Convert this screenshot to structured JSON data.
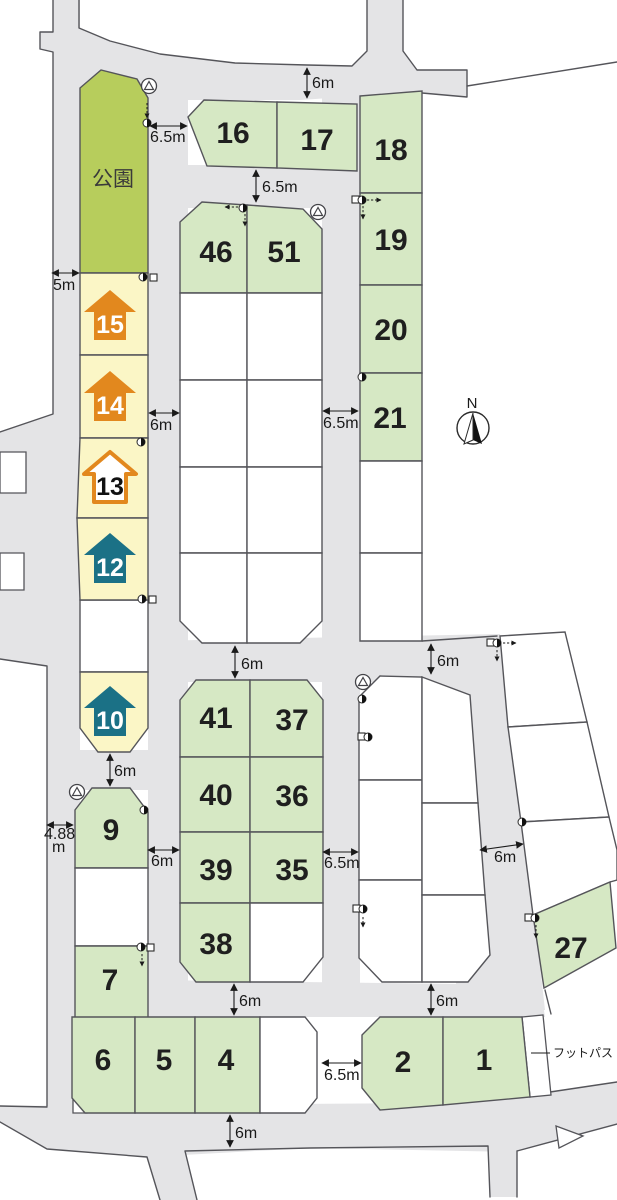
{
  "map": {
    "colors": {
      "road": "#e4e4e6",
      "edge": "#55555a",
      "lot_green": "#d6e8c4",
      "lot_white": "#ffffff",
      "park_green": "#b7cd5c",
      "lot_yellow": "#fbf6c6",
      "house_orange": "#e2881e",
      "house_teal": "#1b7186",
      "text_dark": "#1f1f1f"
    },
    "park": {
      "label": "公園",
      "points": "80,88 101,70 137,79 148,98 148,273 80,273",
      "lx": 113,
      "ly": 186
    },
    "footpath": {
      "label": "フットパス",
      "tx": 553,
      "ty": 1057,
      "leader": [
        531,
        1053,
        550,
        1053
      ]
    },
    "north": {
      "label": "N",
      "cx": 473,
      "cy": 428,
      "r": 16,
      "nx": 472,
      "ny": 408
    },
    "roads": {
      "fills": [
        "53,0 80,0 80,1113 47,1113 47,666 0,659 0,432 53,414 53,52 40,49 40,32 53,32",
        "79,28 110,41 160,54 235,63 307,65 352,66 367,51 367,0 403,0 403,51 417,70 467,70 467,97 422,93 360,96 300,100 200,100 148,100 80,100",
        "148,88 188,88 188,1017 148,1017",
        "322,90 360,90 360,680 322,680",
        "148,165 360,165 360,208 148,208",
        "148,641 500,634 500,682 148,682",
        "322,676 360,676 360,1017 322,1017",
        "148,980 540,985 545,1017 148,1017",
        "47,750 180,750 180,790 47,790",
        "422,640 500,634 535,920 545,1010 460,1017 422,695",
        "0,1106 445,1103 530,1095 617,1082 617,1125 515,1152 310,1148 147,1157 47,1149 0,1122",
        "147,1157 185,1151 197,1200 160,1200",
        "488,1146 517,1151 517,1197 490,1197"
      ],
      "outlines": [
        "M53,0 V32 H40 V49 L53,52 V414 L0,432",
        "M0,659 L47,666 V1106 M0,1106 L47,1107",
        "M79,0 V28 L110,41 L160,54 L235,63 L307,65 L352,66 L367,51 V0",
        "M403,0 V51 L417,70 L467,70 V97 L422,93",
        "M467,86 L617,62",
        "M422,641 L497,636",
        "M0,1122 L47,1149 L147,1157 L160,1200 M185,1151 L197,1200 M185,1151 L310,1148 L488,1146 L490,1197 M517,1151 V1197 M517,1151 L617,1124",
        "M530,1095 L617,1082",
        "M545,990 L551,1014"
      ],
      "white_patches": [
        "0,452 26,452 26,493 0,493",
        "0,553 24,553 24,590 0,590",
        "556,1126 583,1136 559,1148",
        "73,1099 86,1113 73,1113",
        "522,1017 543,1015 551,1095 530,1097"
      ]
    },
    "lots": [
      {
        "label": "16",
        "type": "green",
        "points": "188,117 204,100 277,102 277,168 207,166",
        "lx": 233,
        "ly": 143
      },
      {
        "label": "17",
        "type": "green",
        "points": "277,102 357,104 357,171 277,168",
        "lx": 317,
        "ly": 150
      },
      {
        "label": "18",
        "type": "green",
        "points": "360,96 422,91 422,193 360,193",
        "lx": 391,
        "ly": 160
      },
      {
        "label": "19",
        "type": "green",
        "points": "360,193 422,193 422,285 360,285",
        "lx": 391,
        "ly": 250
      },
      {
        "label": "20",
        "type": "green",
        "points": "360,285 422,285 422,373 360,373",
        "lx": 391,
        "ly": 340
      },
      {
        "label": "21",
        "type": "green",
        "points": "360,373 422,373 422,461 360,461",
        "lx": 390,
        "ly": 428
      },
      {
        "label": "",
        "type": "white",
        "points": "360,461 422,461 422,553 360,553"
      },
      {
        "label": "",
        "type": "white",
        "points": "360,553 422,553 422,641 360,641"
      },
      {
        "label": "46",
        "type": "green",
        "points": "180,222 202,202 247,205 247,293 180,293",
        "lx": 216,
        "ly": 262
      },
      {
        "label": "51",
        "type": "green",
        "points": "247,205 303,209 322,229 322,293 247,293",
        "lx": 284,
        "ly": 262
      },
      {
        "label": "",
        "type": "white",
        "points": "180,293 247,293 247,380 180,380"
      },
      {
        "label": "",
        "type": "white",
        "points": "247,293 322,293 322,380 247,380"
      },
      {
        "label": "",
        "type": "white",
        "points": "180,380 247,380 247,467 180,467"
      },
      {
        "label": "",
        "type": "white",
        "points": "247,380 322,380 322,467 247,467"
      },
      {
        "label": "",
        "type": "white",
        "points": "180,467 247,467 247,553 180,553"
      },
      {
        "label": "",
        "type": "white",
        "points": "247,467 322,467 322,553 247,553"
      },
      {
        "label": "",
        "type": "white",
        "points": "180,553 247,553 247,643 202,643 180,621"
      },
      {
        "label": "",
        "type": "white",
        "points": "247,553 322,553 322,621 300,643 247,643"
      },
      {
        "label": "41",
        "type": "green",
        "points": "180,700 196,680 250,680 250,757 180,757",
        "lx": 216,
        "ly": 728
      },
      {
        "label": "37",
        "type": "green",
        "points": "250,680 307,680 323,700 323,757 250,757",
        "lx": 292,
        "ly": 730
      },
      {
        "label": "40",
        "type": "green",
        "points": "180,757 250,757 250,832 180,832",
        "lx": 216,
        "ly": 805
      },
      {
        "label": "36",
        "type": "green",
        "points": "250,757 323,757 323,832 250,832",
        "lx": 292,
        "ly": 806
      },
      {
        "label": "39",
        "type": "green",
        "points": "180,832 250,832 250,903 180,903",
        "lx": 216,
        "ly": 880
      },
      {
        "label": "35",
        "type": "green",
        "points": "250,832 323,832 323,903 250,903",
        "lx": 292,
        "ly": 880
      },
      {
        "label": "38",
        "type": "green",
        "points": "180,903 250,903 250,982 196,982 180,962",
        "lx": 216,
        "ly": 954
      },
      {
        "label": "",
        "type": "white",
        "points": "250,903 323,903 323,957 303,982 250,982"
      },
      {
        "label": "",
        "type": "white",
        "points": "359,697 380,676 422,677 422,780 359,780"
      },
      {
        "label": "",
        "type": "white",
        "points": "359,780 422,780 422,880 359,880"
      },
      {
        "label": "",
        "type": "white",
        "points": "359,880 422,880 422,982 382,982 359,958"
      },
      {
        "label": "",
        "type": "white",
        "points": "422,677 470,695 478,803 422,803"
      },
      {
        "label": "",
        "type": "white",
        "points": "422,803 478,803 485,895 422,895"
      },
      {
        "label": "",
        "type": "white",
        "points": "422,895 485,895 490,955 468,982 422,982"
      },
      {
        "label": "",
        "type": "white",
        "points": "500,636 565,632 587,722 508,727"
      },
      {
        "label": "",
        "type": "white",
        "points": "508,727 587,722 609,817 521,822"
      },
      {
        "label": "",
        "type": "white",
        "points": "521,822 609,817 617,850 617,880 610,882 533,915"
      },
      {
        "label": "27",
        "type": "green",
        "points": "533,915 610,882 616,948 544,988",
        "lx": 571,
        "ly": 958
      },
      {
        "label": "9",
        "type": "green",
        "points": "75,810 92,788 130,788 148,812 148,868 75,868",
        "lx": 111,
        "ly": 840
      },
      {
        "label": "",
        "type": "white",
        "points": "75,868 148,868 148,946 75,946"
      },
      {
        "label": "7",
        "type": "green",
        "points": "75,946 148,946 148,1018 75,1018",
        "lx": 110,
        "ly": 990
      },
      {
        "label": "6",
        "type": "green",
        "points": "72,1017 135,1017 135,1113 85,1113 72,1098",
        "lx": 103,
        "ly": 1070
      },
      {
        "label": "5",
        "type": "green",
        "points": "135,1017 195,1017 195,1113 135,1113",
        "lx": 164,
        "ly": 1070
      },
      {
        "label": "4",
        "type": "green",
        "points": "195,1017 260,1017 260,1113 195,1113",
        "lx": 226,
        "ly": 1070
      },
      {
        "label": "",
        "type": "white",
        "points": "260,1017 305,1017 317,1032 317,1098 305,1113 260,1113"
      },
      {
        "label": "",
        "type": "white",
        "points": "80,600 148,600 148,672 80,672"
      },
      {
        "label": "2",
        "type": "green",
        "points": "362,1035 380,1017 443,1017 443,1105 380,1110 362,1088",
        "lx": 403,
        "ly": 1072
      },
      {
        "label": "1",
        "type": "green",
        "points": "443,1017 522,1017 530,1097 443,1105",
        "lx": 484,
        "ly": 1070
      }
    ],
    "house_lots": [
      {
        "label": "15",
        "style": "orange",
        "points": "80,273 148,273 148,355 80,355",
        "cx": 110,
        "cy": 316
      },
      {
        "label": "14",
        "style": "orange",
        "points": "80,355 148,355 148,438 80,438",
        "cx": 110,
        "cy": 397
      },
      {
        "label": "13",
        "style": "outline",
        "points": "80,438 148,438 148,518 77,518",
        "cx": 110,
        "cy": 478
      },
      {
        "label": "12",
        "style": "teal",
        "points": "77,518 148,518 148,600 80,600",
        "cx": 110,
        "cy": 559
      },
      {
        "label": "10",
        "style": "teal",
        "points": "80,672 148,672 148,728 130,752 98,752 80,728",
        "cx": 110,
        "cy": 712
      }
    ],
    "dimensions": [
      {
        "text": "6m",
        "tx": 312,
        "ty": 88,
        "line": [
          307,
          68,
          307,
          98
        ]
      },
      {
        "text": "6.5m",
        "tx": 150,
        "ty": 142,
        "line": [
          150,
          126,
          187,
          126
        ]
      },
      {
        "text": "6.5m",
        "tx": 262,
        "ty": 192,
        "line": [
          256,
          170,
          256,
          202
        ]
      },
      {
        "text": "5m",
        "tx": 53,
        "ty": 290,
        "line": [
          52,
          273,
          79,
          273
        ]
      },
      {
        "text": "6m",
        "tx": 150,
        "ty": 430,
        "line": [
          149,
          413,
          179,
          413
        ]
      },
      {
        "text": "6.5m",
        "tx": 323,
        "ty": 428,
        "line": [
          323,
          411,
          358,
          411
        ]
      },
      {
        "text": "6m",
        "tx": 241,
        "ty": 669,
        "line": [
          235,
          646,
          235,
          678
        ]
      },
      {
        "text": "6m",
        "tx": 437,
        "ty": 666,
        "line": [
          431,
          644,
          431,
          674
        ]
      },
      {
        "text": "6m",
        "tx": 494,
        "ty": 862,
        "line": [
          480,
          850,
          523,
          844
        ]
      },
      {
        "text": "6m",
        "tx": 114,
        "ty": 776,
        "line": [
          110,
          754,
          110,
          786
        ]
      },
      {
        "text": "4.88",
        "tx": 44,
        "ty": 839,
        "line": [
          47,
          825,
          73,
          825
        ]
      },
      {
        "text": "m",
        "tx": 52,
        "ty": 852,
        "line": null
      },
      {
        "text": "6m",
        "tx": 151,
        "ty": 866,
        "line": [
          148,
          850,
          179,
          850
        ]
      },
      {
        "text": "6.5m",
        "tx": 324,
        "ty": 868,
        "line": [
          323,
          852,
          358,
          852
        ]
      },
      {
        "text": "6m",
        "tx": 239,
        "ty": 1006,
        "line": [
          234,
          984,
          234,
          1015
        ]
      },
      {
        "text": "6m",
        "tx": 436,
        "ty": 1006,
        "line": [
          431,
          984,
          431,
          1015
        ]
      },
      {
        "text": "6.5m",
        "tx": 324,
        "ty": 1080,
        "line": [
          322,
          1063,
          361,
          1063
        ]
      },
      {
        "text": "6m",
        "tx": 235,
        "ty": 1138,
        "line": [
          230,
          1115,
          230,
          1147
        ]
      }
    ],
    "hydrants": [
      {
        "x": 149,
        "y": 86
      },
      {
        "x": 318,
        "y": 212
      },
      {
        "x": 363,
        "y": 682
      },
      {
        "x": 77,
        "y": 792
      }
    ],
    "markers": [
      {
        "x": 147,
        "y": 123,
        "sq": null,
        "dash": [
          [
            147,
            103,
            147,
            118
          ]
        ]
      },
      {
        "x": 143,
        "y": 277,
        "sq": [
          150,
          274
        ],
        "dash": []
      },
      {
        "x": 141,
        "y": 442,
        "sq": null,
        "dash": []
      },
      {
        "x": 142,
        "y": 599,
        "sq": [
          149,
          596
        ],
        "dash": []
      },
      {
        "x": 243,
        "y": 208,
        "sq": null,
        "dash": [
          [
            238,
            207,
            225,
            207
          ],
          [
            245,
            214,
            245,
            226
          ]
        ]
      },
      {
        "x": 362,
        "y": 200,
        "sq": [
          352,
          196
        ],
        "dash": [
          [
            367,
            200,
            381,
            200
          ],
          [
            363,
            206,
            363,
            219
          ]
        ]
      },
      {
        "x": 362,
        "y": 377,
        "sq": null,
        "dash": []
      },
      {
        "x": 362,
        "y": 699,
        "sq": null,
        "dash": []
      },
      {
        "x": 368,
        "y": 737,
        "sq": [
          358,
          733
        ],
        "dash": []
      },
      {
        "x": 497,
        "y": 643,
        "sq": [
          487,
          639
        ],
        "dash": [
          [
            503,
            643,
            516,
            643
          ],
          [
            497,
            650,
            497,
            661
          ]
        ]
      },
      {
        "x": 522,
        "y": 822,
        "sq": null,
        "dash": []
      },
      {
        "x": 535,
        "y": 918,
        "sq": [
          525,
          914
        ],
        "dash": [
          [
            536,
            925,
            536,
            938
          ]
        ]
      },
      {
        "x": 141,
        "y": 947,
        "sq": [
          147,
          944
        ],
        "dash": [
          [
            142,
            954,
            142,
            966
          ]
        ]
      },
      {
        "x": 363,
        "y": 909,
        "sq": [
          353,
          905
        ],
        "dash": [
          [
            363,
            917,
            363,
            927
          ]
        ]
      },
      {
        "x": 144,
        "y": 810,
        "sq": null,
        "dash": []
      }
    ]
  }
}
